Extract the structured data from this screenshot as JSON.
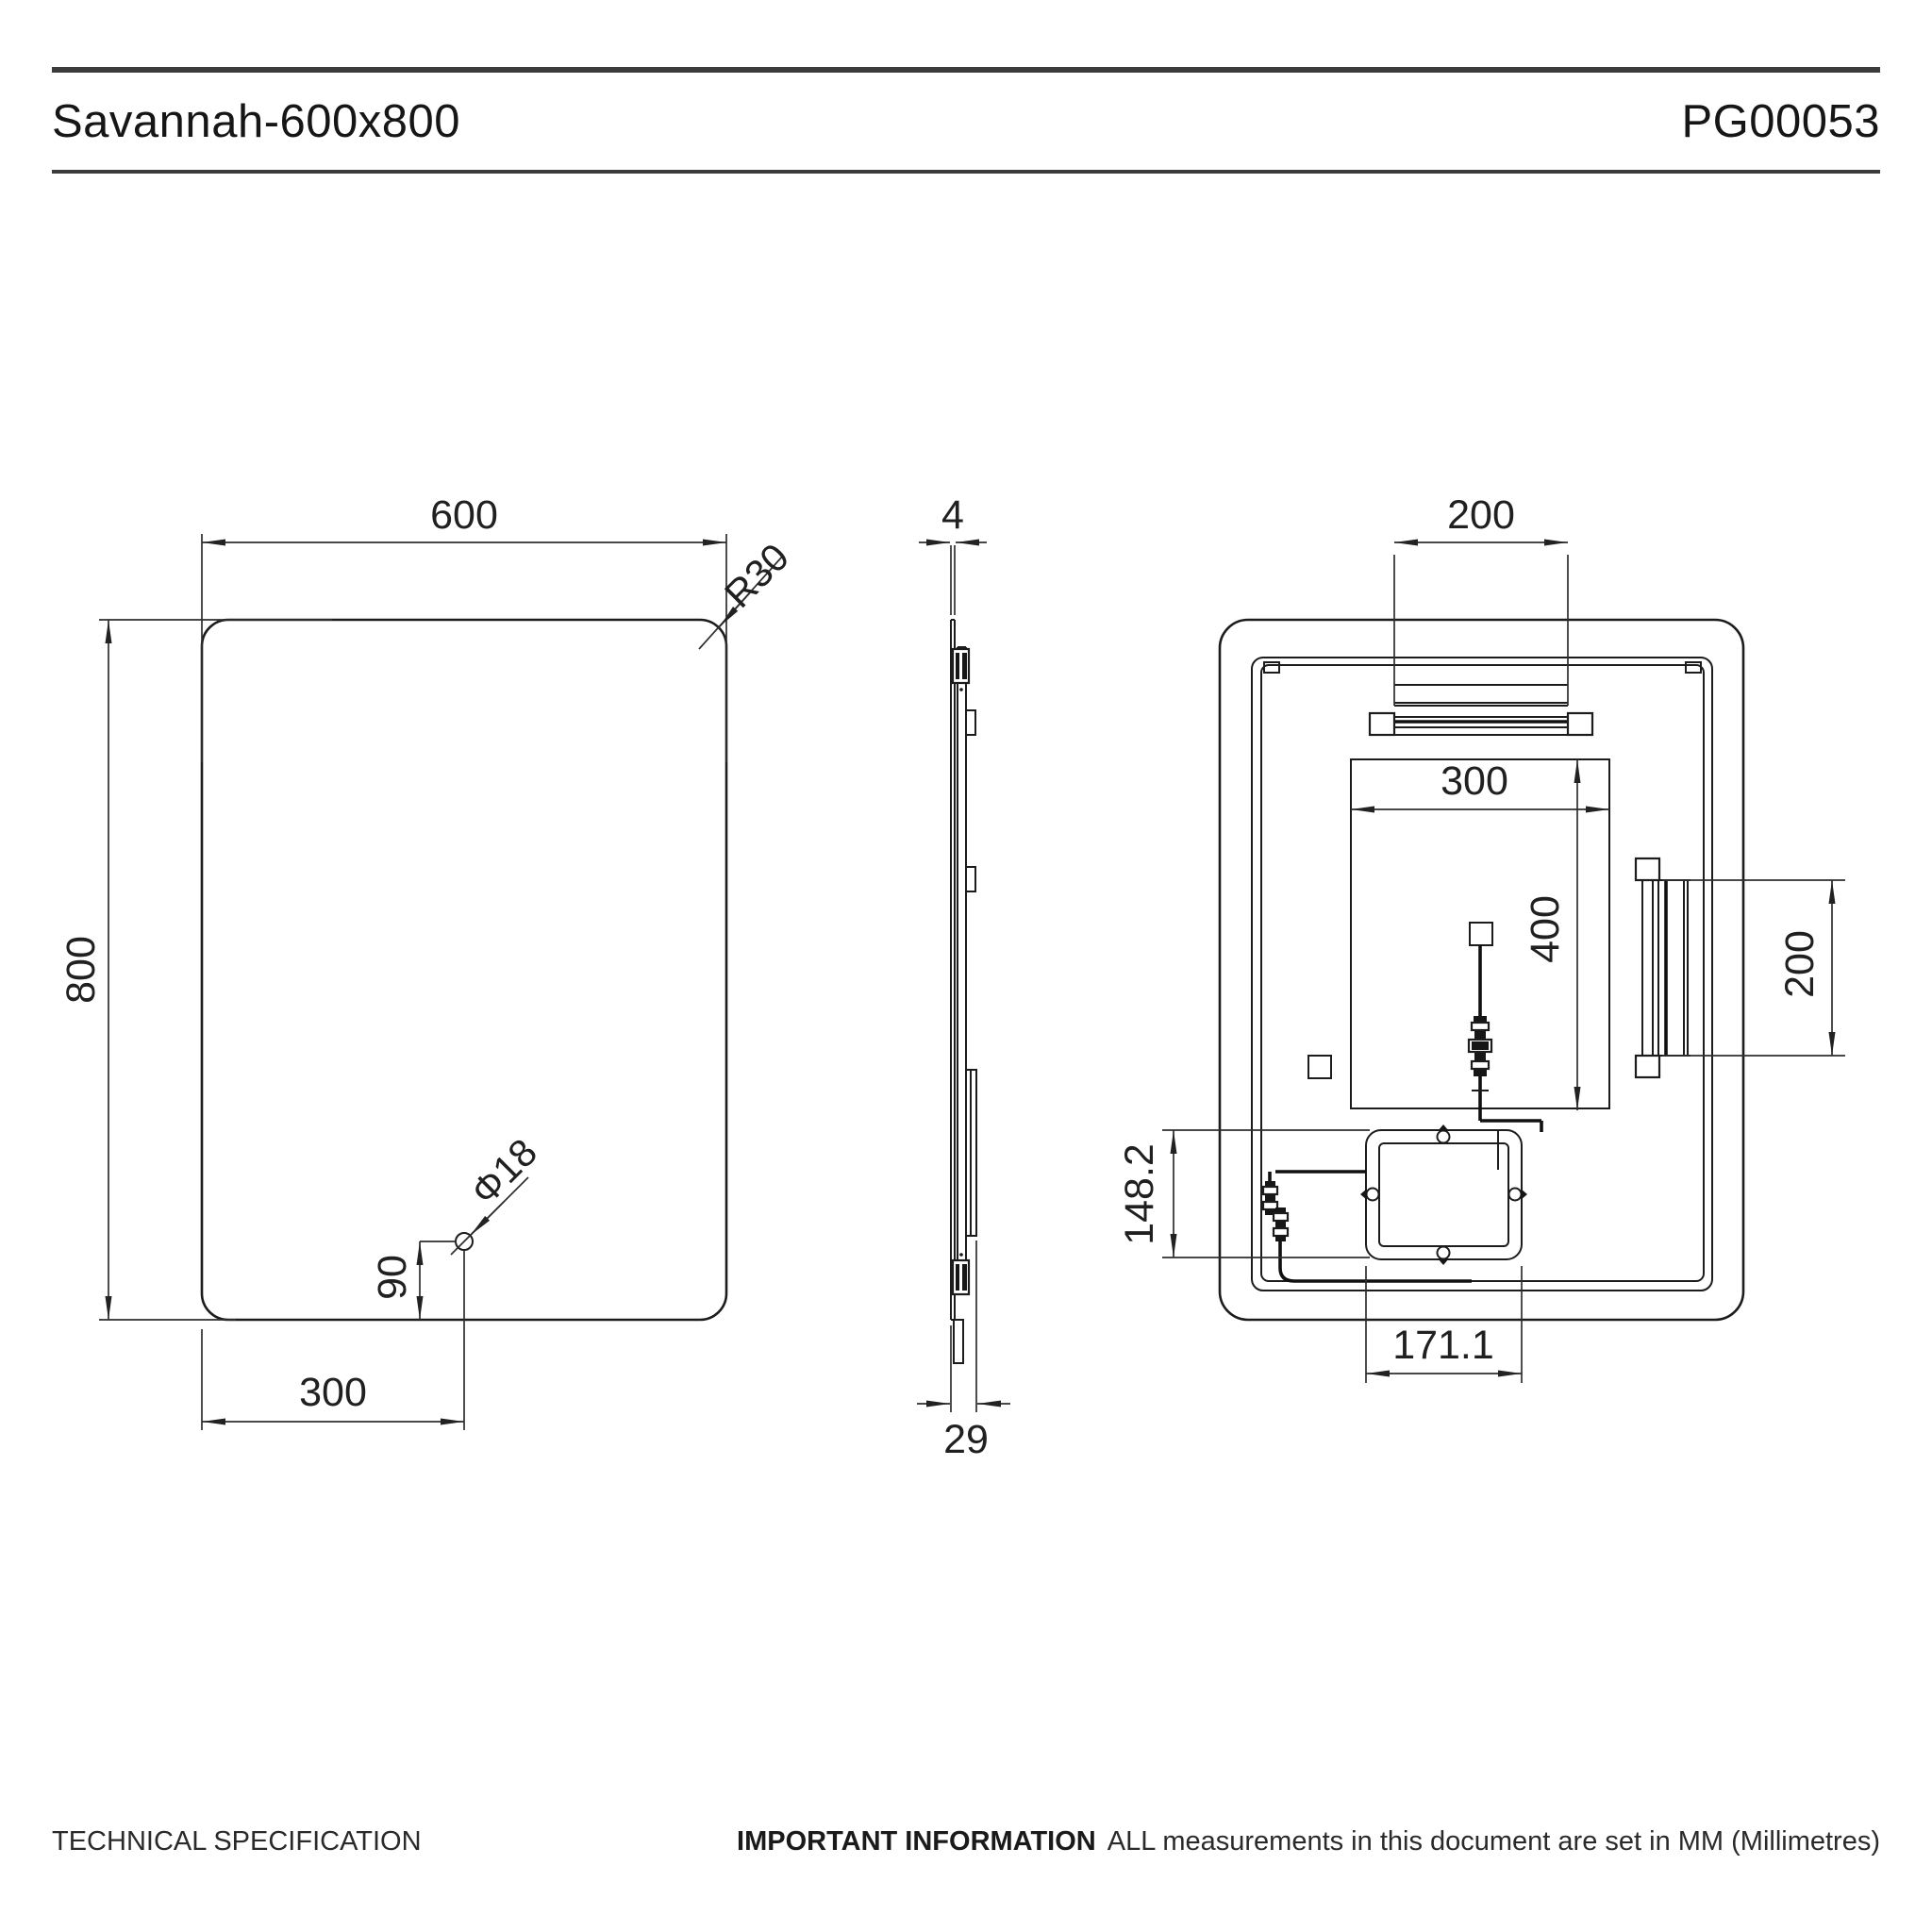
{
  "header": {
    "title": "Savannah-600x800",
    "code": "PG00053"
  },
  "footer": {
    "left": "TECHNICAL SPECIFICATION",
    "important_label": "IMPORTANT INFORMATION",
    "important_text": "ALL measurements in this document are set in MM (Millimetres)"
  },
  "units": "MM",
  "front_view": {
    "width": "600",
    "height": "800",
    "corner_radius": "R30",
    "hole_diameter": "Φ18",
    "hole_from_bottom": "90",
    "hole_from_left": "300"
  },
  "side_view": {
    "glass_thickness": "4",
    "total_depth": "29"
  },
  "back_view": {
    "top_bracket_width": "200",
    "demister_width": "300",
    "demister_height": "400",
    "side_bracket_height": "200",
    "junction_box_offset": "148.2",
    "junction_box_width": "171.1"
  }
}
